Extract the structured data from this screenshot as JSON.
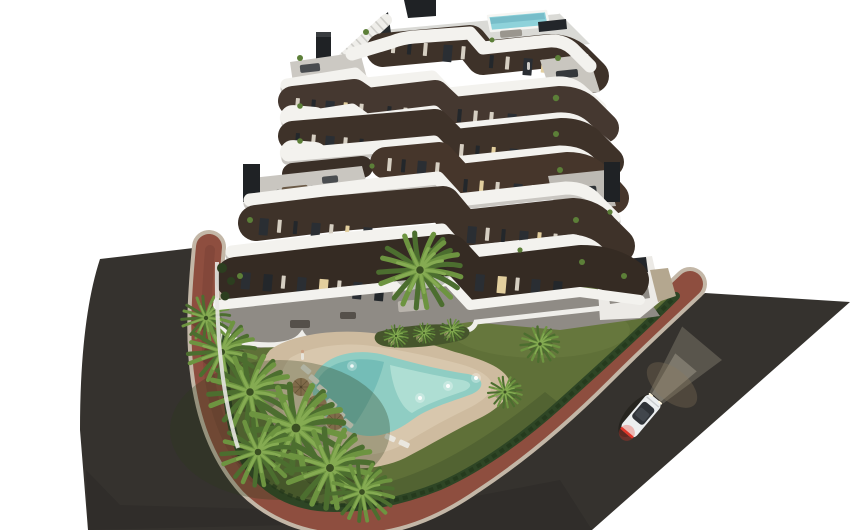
{
  "scene": {
    "type": "3d-architectural-rendering",
    "view": "aerial-dusk",
    "building": {
      "floors_visible": 7,
      "balcony_style": "white-curved-bands",
      "facade_style": "dark-brown-with-vertical-windows",
      "rooftop_pool": true,
      "rooftop_stair": true,
      "chimneys": 3
    },
    "garden": {
      "pool_shape": "freeform-boomerang",
      "pool_lights": 5,
      "umbrellas": 3,
      "sun_loungers": 8,
      "palm_trees": 13,
      "hedge_border": true,
      "planting_bed_lights": 3
    },
    "streets": {
      "roads": 2,
      "sidewalk_color_name": "red-brick",
      "cars": 1,
      "car": {
        "color_name": "white",
        "headlights_on": true,
        "taillights_on": true
      }
    },
    "people_visible": 3
  },
  "colors": {
    "background": "#ffffff",
    "asphalt": "#35322e",
    "asphalt_dark": "#2b2825",
    "sidewalk": "#8e4e3f",
    "curb": "#c3b7a7",
    "lawn": "#5f7038",
    "lawn_dark": "#46552c",
    "hedge": "#2e4525",
    "sand": "#cebb9f",
    "sand_light": "#dbcbb0",
    "pool_water": "#8fcdc3",
    "pool_deep": "#5fb0ad",
    "roof_pool": "#8ed2da",
    "facade": "#3e3229",
    "facade_light": "#4a3b30",
    "band_white": "#f3f2ee",
    "band_shadow": "#c9c6c1",
    "deck": "#cbc8c2",
    "roof_deck": "#dadad6",
    "patio": "#8f8b85",
    "chimney": "#1f2225",
    "window_frame": "#d6cfc2",
    "window_glass": "#23272b",
    "window_lit": "#e3cf9e",
    "palm_green": "#6d9440",
    "palm_dark": "#4c6e2f",
    "trunk": "#8a7355",
    "umbrella": "#a5805f",
    "lounger": "#eae7df",
    "car_body": "#eceff0",
    "car_glass": "#2f3338",
    "taillight": "#e03528",
    "headlight_beam": "#fff3d8"
  }
}
